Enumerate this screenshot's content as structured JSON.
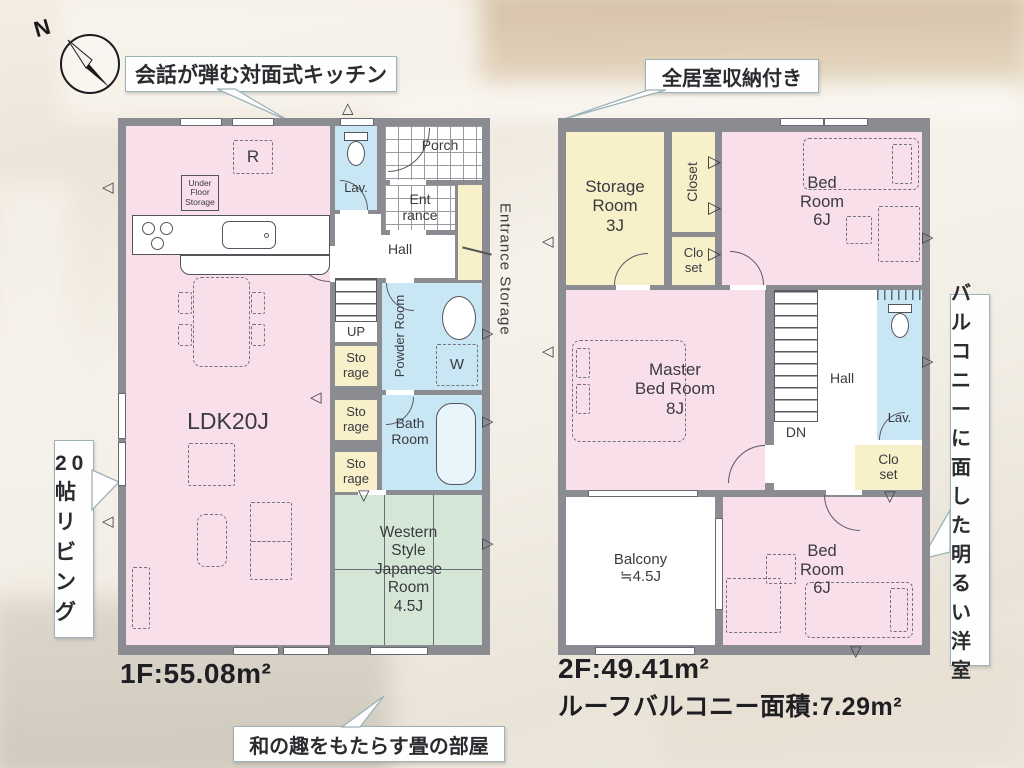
{
  "compass": {
    "label": "N"
  },
  "colors": {
    "wall": "#8b8b92",
    "room_pink": "#f8dfe9",
    "room_yellow": "#f7f0c8",
    "room_blue": "#c9e6f4",
    "room_green": "#d4e7d7",
    "callout_border": "#9db3b7"
  },
  "callouts": {
    "kitchen": "会話が弾む対面式キッチン",
    "storage": "全居室収納付き",
    "living": "20帖リビング",
    "balcony_room": "バルコニーに面した明るい洋室",
    "tatami": "和の趣をもたらす畳の部屋"
  },
  "floor1": {
    "area_label": "1F:55.08m²",
    "rooms": {
      "ldk": "LDK20J",
      "porch": "Porch",
      "entrance": "Ent\nrance",
      "entrance_storage": "Entrance Storage",
      "lavatory": "Lav.",
      "hall": "Hall",
      "up": "UP",
      "refrigerator": "R",
      "under_floor_storage": "Under\nFloor\nStorage",
      "storage": "Sto\nrage",
      "powder_room": "Powder\nRoom",
      "washer": "W",
      "bath_room": "Bath\nRoom",
      "japanese_room": "Western\nStyle\nJapanese\nRoom\n4.5J"
    }
  },
  "floor2": {
    "area_label": "2F:49.41m²",
    "roof_balcony_label": "ルーフバルコニー面積:7.29m²",
    "rooms": {
      "storage_room": "Storage\nRoom\n3J",
      "closet": "Closet",
      "closet_small": "Clo\nset",
      "bedroom_6j": "Bed\nRoom\n6J",
      "master_bedroom": "Master\nBed Room\n8J",
      "hall": "Hall",
      "down": "DN",
      "lavatory": "Lav.",
      "balcony": "Balcony\n≒4.5J"
    }
  }
}
